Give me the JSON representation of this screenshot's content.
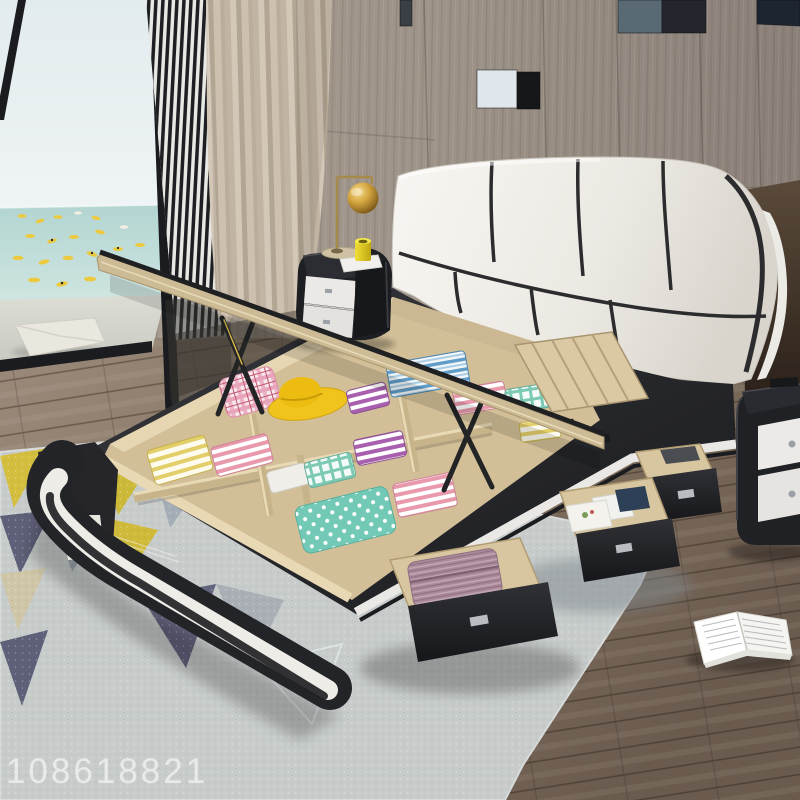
{
  "image": {
    "kind": "product-photo",
    "subject": "modern black and white storage platform bed with lift-up mattress and pull-out side drawers",
    "setting": "bedroom with wood panel wall, beige curtain and sea-view window with yellow kayaks",
    "width_px": 800,
    "height_px": 800
  },
  "watermark": {
    "text": "108618821",
    "color": "rgba(255,255,255,0.55)"
  },
  "scene": {
    "wall": {
      "label": "wood plank wall paneling with glass inserts",
      "color": "#9d9389"
    },
    "window": {
      "label": "floor-to-ceiling window, sea view",
      "sky": "#e7eff1",
      "sea": "#bcd9d5",
      "kayak_color": "#ecc93e",
      "deck": "#d5d6cd"
    },
    "slat_screen": {
      "label": "vertical slat screen",
      "dark": "#1e1f22",
      "light": "#e8e8e4"
    },
    "curtain": {
      "label": "beige curtain",
      "color": "#c6b9a8"
    },
    "headboard": {
      "label": "white leather headboard, 8 panels with black piping",
      "leather": "#f2efe9",
      "piping": "#2c2c2e"
    },
    "bed_frame": {
      "label": "black upholstered platform with white trim stripe",
      "black": "#26262a",
      "trim": "#eeece7"
    },
    "storage": {
      "label": "open lift-up storage box with folded textiles and yellow sun hat",
      "plywood": "#d8c59e",
      "hat": "#f2c81e"
    },
    "drawers": {
      "label": "three black pull-out side drawers with clothes and books",
      "front": "#222327"
    },
    "nightstand_left": {
      "label": "black nightstand with white drawers, gold sphere lamp, yellow cup",
      "body": "#1e1f23",
      "drawer": "#ebe9e5",
      "lamp_gold": "#c89a3c",
      "cup": "#e6d42e"
    },
    "nightstand_right": {
      "label": "black nightstand with white drawers (right edge)",
      "body": "#202125"
    },
    "rug": {
      "label": "geometric triangle rug",
      "base": "#c7cccb",
      "yellow": "#d4be3e",
      "purple": "#5e5f78",
      "gray": "#98a1ab"
    },
    "floor": {
      "label": "dark wood plank floor",
      "color": "#7c6a5d"
    },
    "book": {
      "label": "open book lying on floor",
      "pages": "#f4f4f1"
    }
  }
}
